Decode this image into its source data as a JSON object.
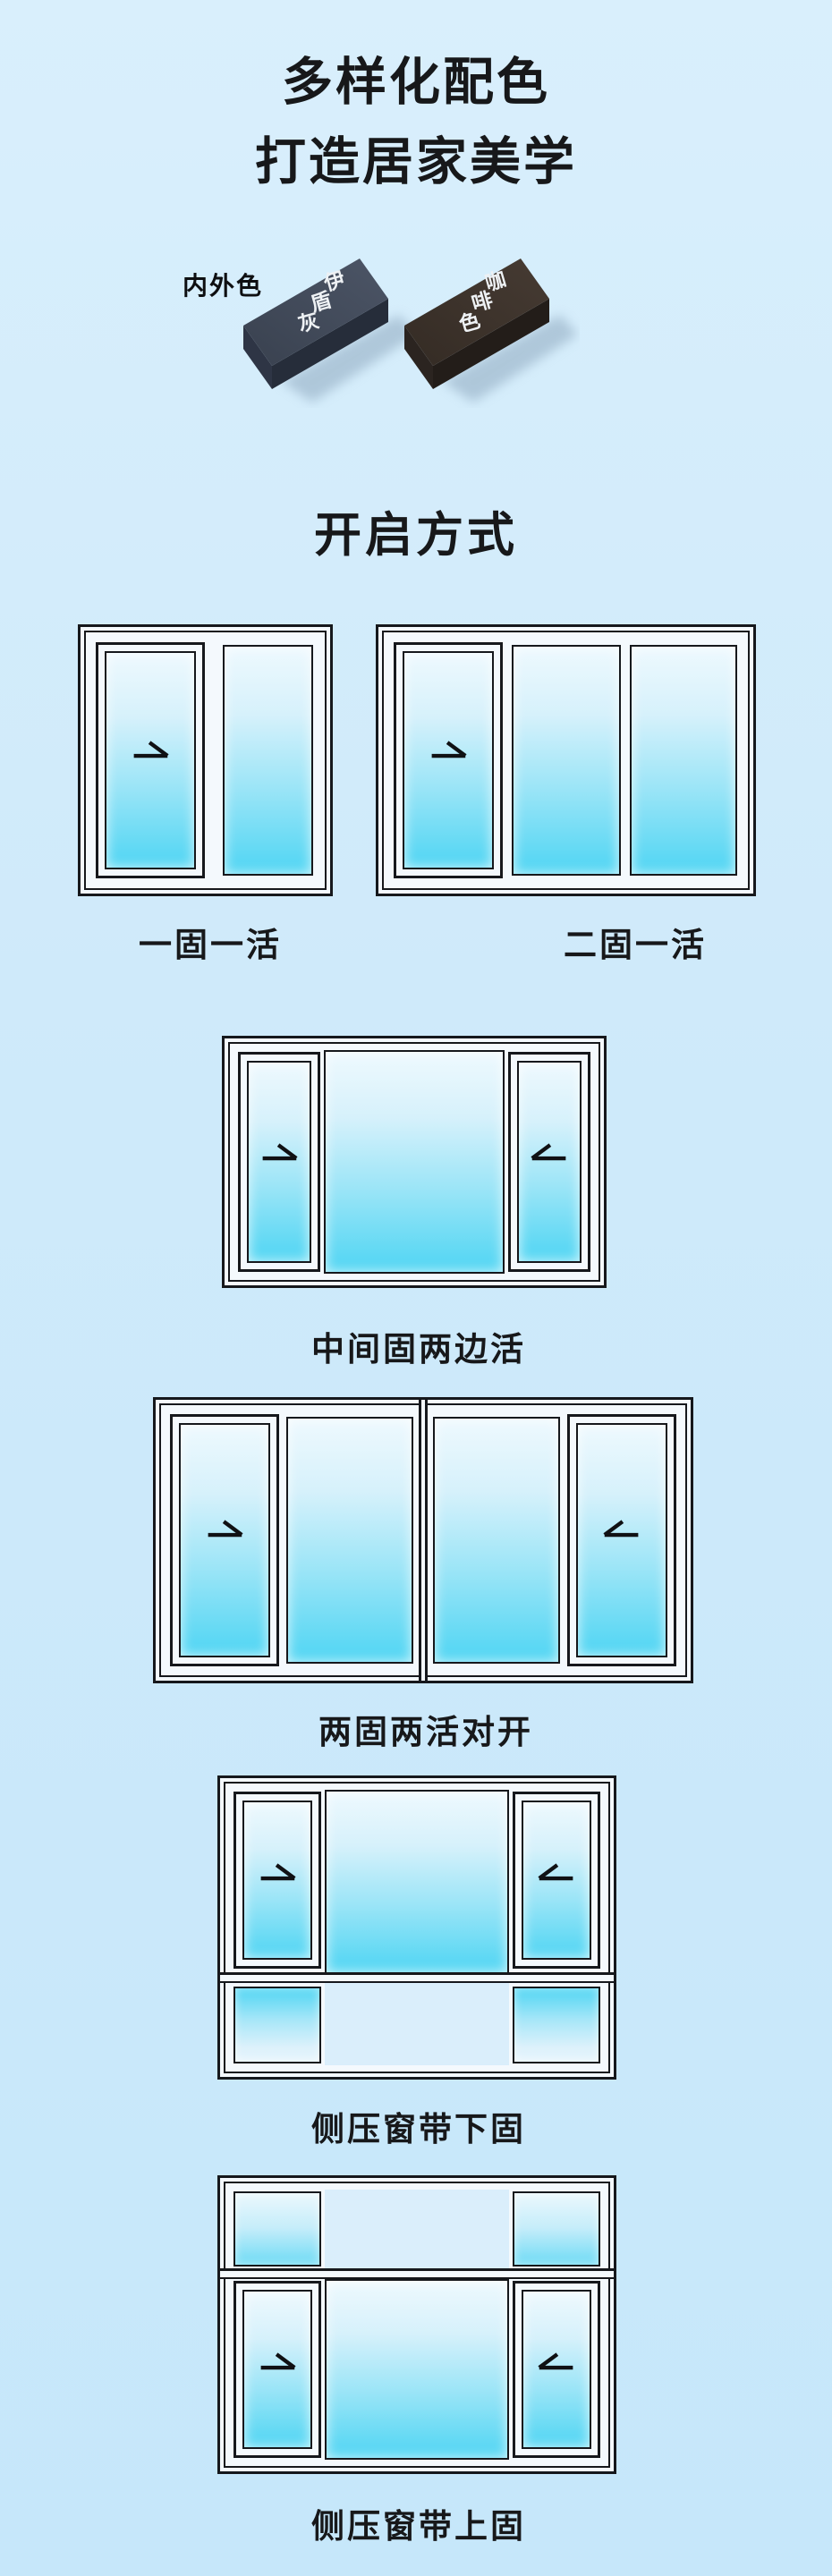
{
  "theme": {
    "background_top": "#d9effc",
    "background_bottom": "#c6e7fa",
    "outline": "#16181c",
    "frame_white": "#f4f9fd",
    "glass_top": "#eef9fe",
    "glass_bottom": "#4fd5f3",
    "swatch_gray_top": "#434c5d",
    "swatch_gray_side": "#262d3a",
    "swatch_coffee_top": "#3c322b",
    "swatch_coffee_side": "#231d19"
  },
  "header": {
    "title_line1": "多样化配色",
    "title_line2": "打造居家美学"
  },
  "swatches": {
    "label": "内外色",
    "items": [
      {
        "name": "伊盾灰",
        "chars": [
          "伊",
          "盾",
          "灰"
        ],
        "top_color": "#434c5d",
        "side_color": "#262d3a"
      },
      {
        "name": "咖啡色",
        "chars": [
          "咖",
          "啡",
          "色"
        ],
        "top_color": "#3c322b",
        "side_color": "#231d19"
      }
    ]
  },
  "section": {
    "heading": "开启方式"
  },
  "windows": {
    "items": [
      {
        "label": "一固一活",
        "arrows": [
          "right"
        ]
      },
      {
        "label": "二固一活",
        "arrows": [
          "right"
        ]
      },
      {
        "label": "中间固两边活",
        "arrows": [
          "right",
          "left"
        ]
      },
      {
        "label": "两固两活对开",
        "arrows": [
          "right",
          "left"
        ]
      },
      {
        "label": "侧压窗带下固",
        "arrows": [
          "right",
          "left"
        ]
      },
      {
        "label": "侧压窗带上固",
        "arrows": [
          "right",
          "left"
        ]
      }
    ]
  }
}
